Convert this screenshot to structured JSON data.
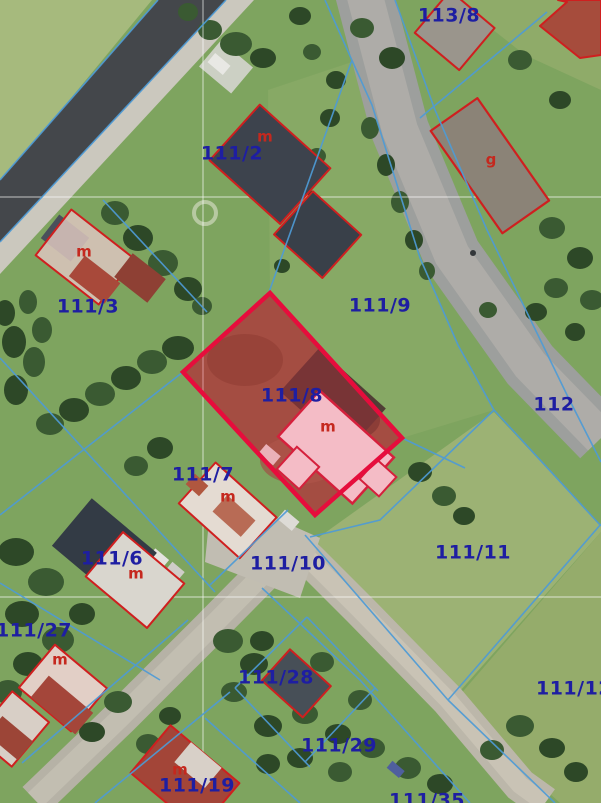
{
  "map": {
    "description": "Aerial orthophoto with cadastral parcel overlay",
    "highlighted_parcel": "111/8",
    "colors": {
      "parcel_label": "#1e1ea2",
      "building_label": "#c5281e",
      "boundary_line": "#4e9bd6",
      "building_outline": "#cf1f1f",
      "highlight_border": "#e60d3c",
      "highlight_fill": "rgba(228,25,60,0.27)",
      "grid_line": "rgba(255,255,255,0.55)"
    },
    "parcel_labels": [
      {
        "text": "113/8",
        "x": 449,
        "y": 16
      },
      {
        "text": "111/2",
        "x": 232,
        "y": 154
      },
      {
        "text": "111/3",
        "x": 88,
        "y": 307
      },
      {
        "text": "111/9",
        "x": 380,
        "y": 306
      },
      {
        "text": "111/8",
        "x": 292,
        "y": 396
      },
      {
        "text": "112",
        "x": 554,
        "y": 405
      },
      {
        "text": "111/7",
        "x": 203,
        "y": 475
      },
      {
        "text": "111/11",
        "x": 473,
        "y": 553
      },
      {
        "text": "111/6",
        "x": 112,
        "y": 559
      },
      {
        "text": "111/10",
        "x": 288,
        "y": 564
      },
      {
        "text": "111/27",
        "x": 34,
        "y": 631
      },
      {
        "text": "111/28",
        "x": 276,
        "y": 678
      },
      {
        "text": "111/12",
        "x": 574,
        "y": 689
      },
      {
        "text": "111/29",
        "x": 339,
        "y": 746
      },
      {
        "text": "111/19",
        "x": 197,
        "y": 786
      },
      {
        "text": "111/35",
        "x": 427,
        "y": 801
      }
    ],
    "building_labels": [
      {
        "text": "m",
        "x": 265,
        "y": 137
      },
      {
        "text": "g",
        "x": 491,
        "y": 160
      },
      {
        "text": "m",
        "x": 84,
        "y": 252
      },
      {
        "text": "m",
        "x": 328,
        "y": 427
      },
      {
        "text": "m",
        "x": 228,
        "y": 497
      },
      {
        "text": "m",
        "x": 136,
        "y": 574
      },
      {
        "text": "m",
        "x": 60,
        "y": 660
      },
      {
        "text": "m",
        "x": 180,
        "y": 770
      }
    ]
  }
}
